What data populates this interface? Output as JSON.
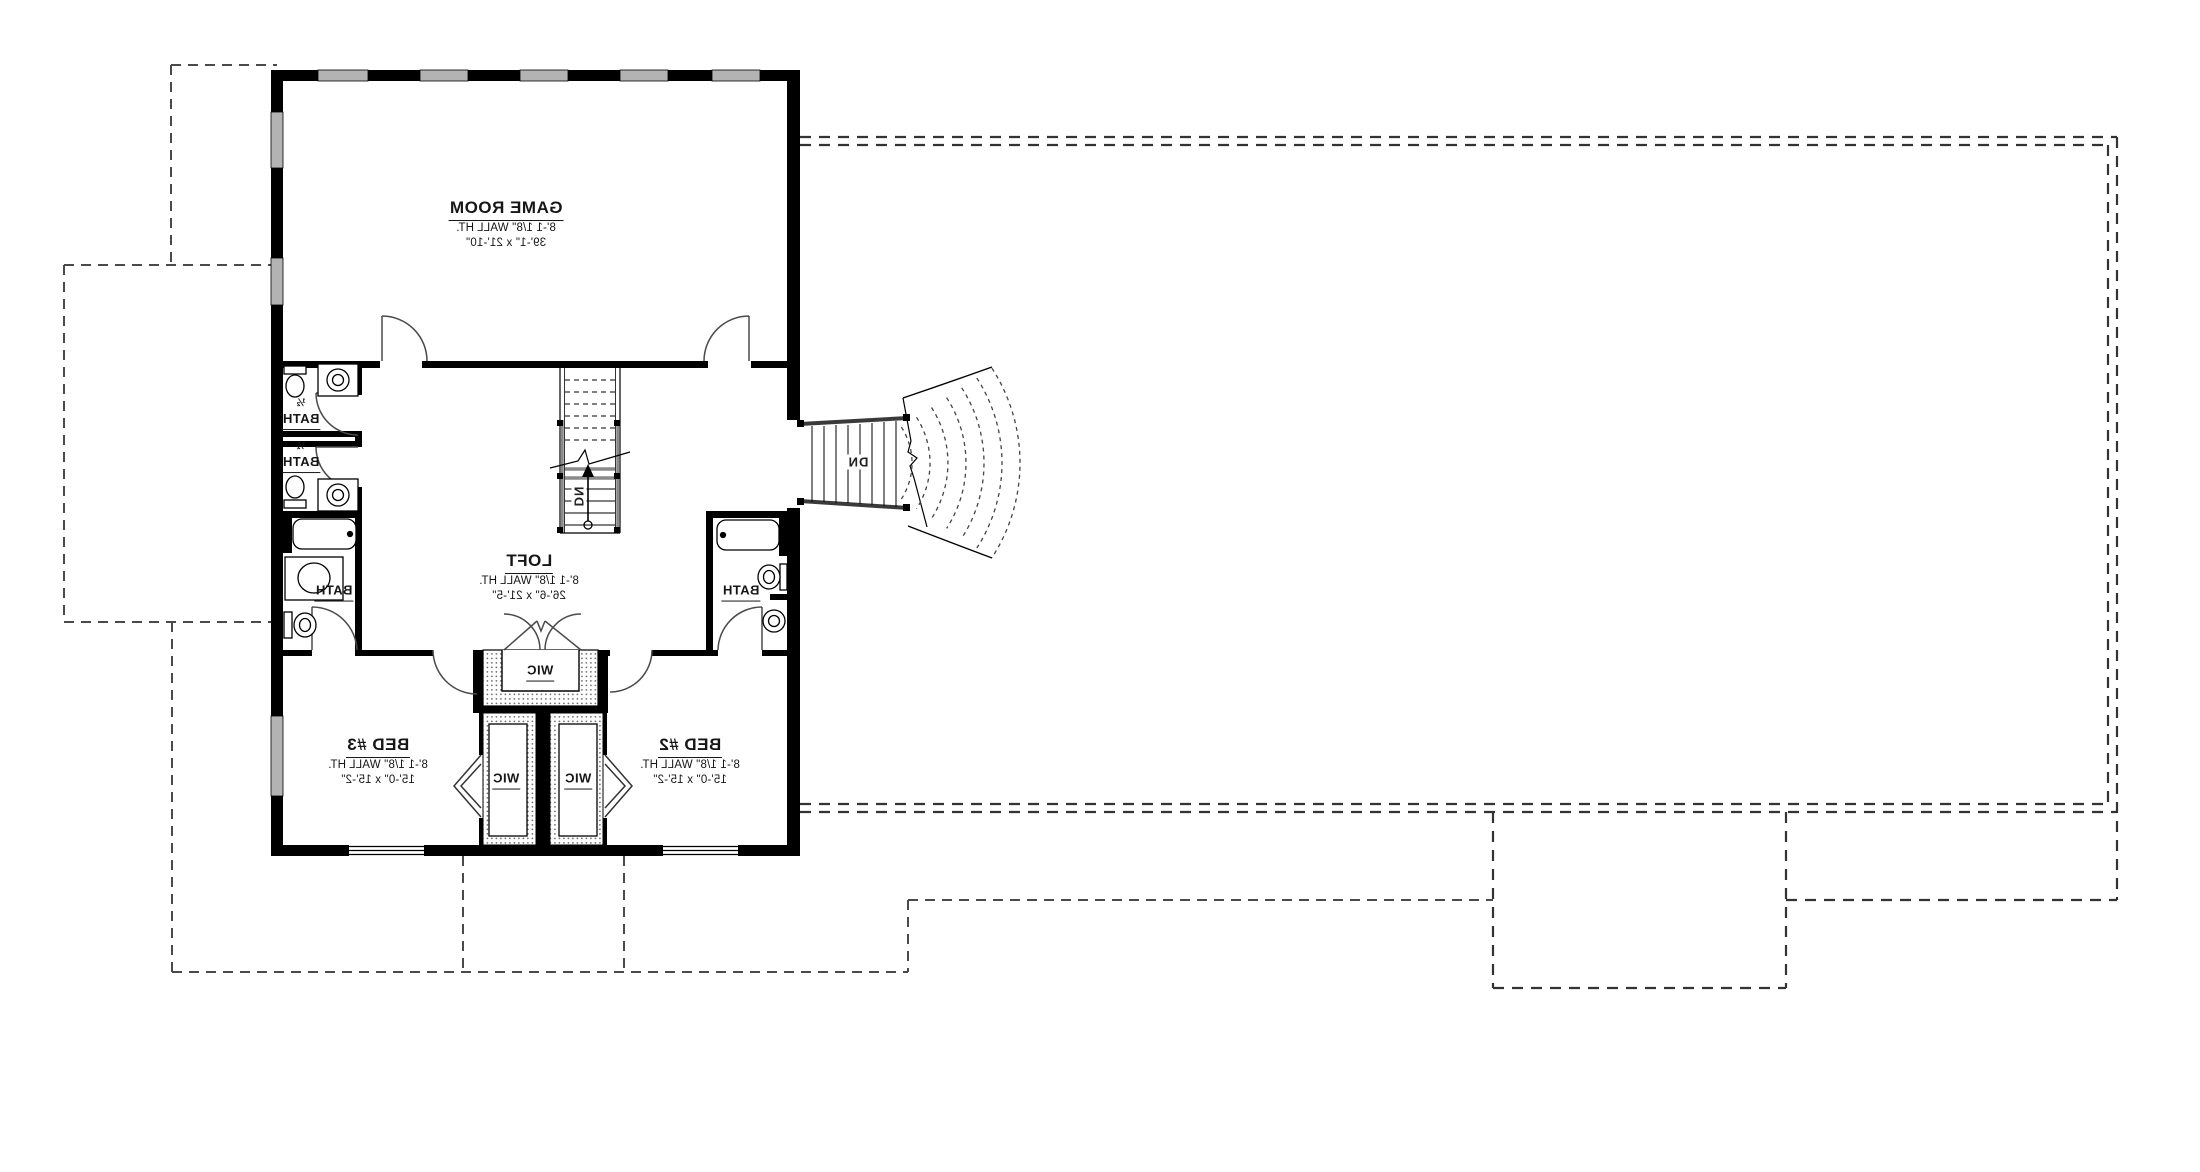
{
  "plan": {
    "rooms": {
      "game_room": {
        "name": "GAME ROOM",
        "wall_height": "8'-1 1/8\" WALL HT.",
        "dimensions": "39'-1\" x 21'-10\""
      },
      "loft": {
        "name": "LOFT",
        "wall_height": "8'-1 1/8\" WALL HT.",
        "dimensions": "26'-6\" x 21'-5\""
      },
      "bed_3": {
        "name": "BED #3",
        "wall_height": "8'-1 1/8\" WALL HT.",
        "dimensions": "15'-0\" x 15'-2\""
      },
      "bed_2": {
        "name": "BED #2",
        "wall_height": "8'-1 1/8\" WALL HT.",
        "dimensions": "15'-0\" x 15'-2\""
      },
      "half_bath_upper": {
        "fraction": "½",
        "name": "BATH"
      },
      "half_bath_lower": {
        "fraction": "½",
        "name": "BATH"
      },
      "bath_left": {
        "name": "BATH"
      },
      "bath_right": {
        "name": "BATH"
      },
      "wic_top": {
        "name": "WIC"
      },
      "wic_left": {
        "name": "WIC"
      },
      "wic_right": {
        "name": "WIC"
      }
    },
    "stairs": {
      "interior_down_label": "DN",
      "exterior_down_label": "DN"
    },
    "colors": {
      "wall": "#000000",
      "window": "#b3b3b3",
      "railing": "#8a8a8a",
      "dashed_line": "#4a4a4a"
    }
  }
}
